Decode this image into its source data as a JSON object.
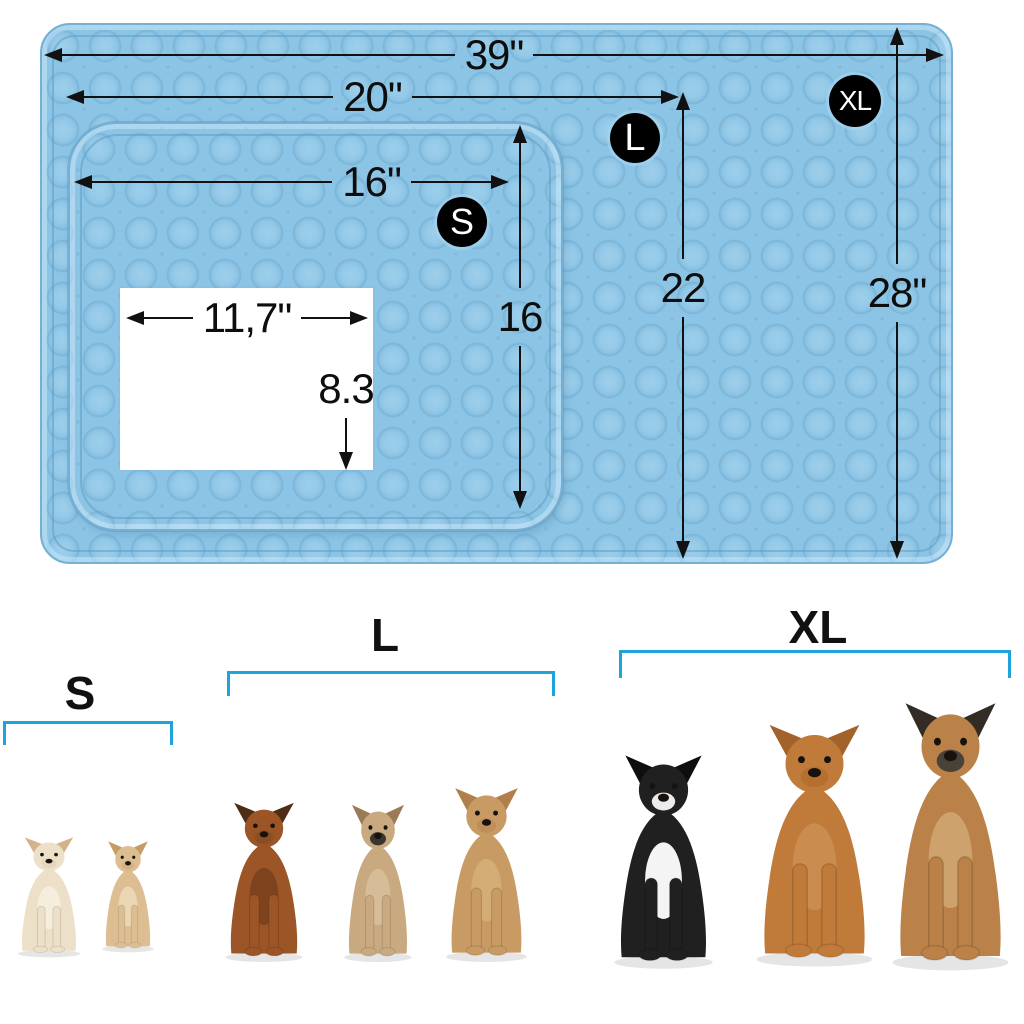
{
  "dimensions": {
    "xl_width": "39\"",
    "l_width": "20\"",
    "s_width": "16\"",
    "s_height": "16",
    "l_height": "22",
    "xl_height": "28\"",
    "insert_width": "11,7\"",
    "insert_height": "8.3"
  },
  "badges": {
    "s": "S",
    "l": "L",
    "xl": "XL"
  },
  "size_groups": {
    "s": "S",
    "l": "L",
    "xl": "XL"
  },
  "colors": {
    "mat": "#8CC4E5",
    "mat_edge": "#74B0D4",
    "window": "#FFFFFF",
    "dimension_lines": "#111111",
    "badge_bg": "#000000",
    "badge_text": "#FFFFFF",
    "bracket": "#1FA3DC"
  },
  "dogs": [
    {
      "name": "chihuahua-cream",
      "size_group": "S",
      "layout": {
        "x": 10,
        "y": 836,
        "w": 78,
        "h": 122
      },
      "colors": {
        "body": "#EDE0C8",
        "accent": "#D3B38C",
        "chest": "#F6EEDD",
        "muzzle": "#E6D6BC"
      }
    },
    {
      "name": "chihuahua-tan",
      "size_group": "S",
      "layout": {
        "x": 96,
        "y": 840,
        "w": 64,
        "h": 113
      },
      "colors": {
        "body": "#DDBE92",
        "accent": "#C49C66",
        "chest": "#EBD7B4",
        "muzzle": "#D3B184"
      }
    },
    {
      "name": "dachshund",
      "size_group": "L",
      "layout": {
        "x": 216,
        "y": 801,
        "w": 96,
        "h": 162
      },
      "colors": {
        "body": "#9B5526",
        "accent": "#4F2C15",
        "chest": "#7E421C",
        "muzzle": "#8C4D22"
      }
    },
    {
      "name": "french-bulldog",
      "size_group": "L",
      "layout": {
        "x": 336,
        "y": 803,
        "w": 84,
        "h": 160
      },
      "colors": {
        "body": "#C8A980",
        "accent": "#9A7B55",
        "chest": "#D6BC97",
        "muzzle": "#3B352F"
      }
    },
    {
      "name": "cockapoo",
      "size_group": "L",
      "layout": {
        "x": 436,
        "y": 786,
        "w": 101,
        "h": 177
      },
      "colors": {
        "body": "#C89A64",
        "accent": "#B08048",
        "chest": "#D3AC76",
        "muzzle": "#BE8F58"
      }
    },
    {
      "name": "border-collie",
      "size_group": "XL",
      "layout": {
        "x": 602,
        "y": 753,
        "w": 123,
        "h": 217
      },
      "colors": {
        "body": "#202020",
        "accent": "#0E0E0E",
        "chest": "#F4F4F4",
        "muzzle": "#ECECEC"
      }
    },
    {
      "name": "labrador",
      "size_group": "XL",
      "layout": {
        "x": 742,
        "y": 722,
        "w": 145,
        "h": 246
      },
      "colors": {
        "body": "#C07B3B",
        "accent": "#A3622A",
        "chest": "#CB8C50",
        "muzzle": "#B5702F"
      }
    },
    {
      "name": "german-shepherd",
      "size_group": "XL",
      "layout": {
        "x": 878,
        "y": 700,
        "w": 145,
        "h": 272
      },
      "colors": {
        "body": "#BA8148",
        "accent": "#332C24",
        "chest": "#CDA26C",
        "muzzle": "#4A4138"
      }
    }
  ]
}
